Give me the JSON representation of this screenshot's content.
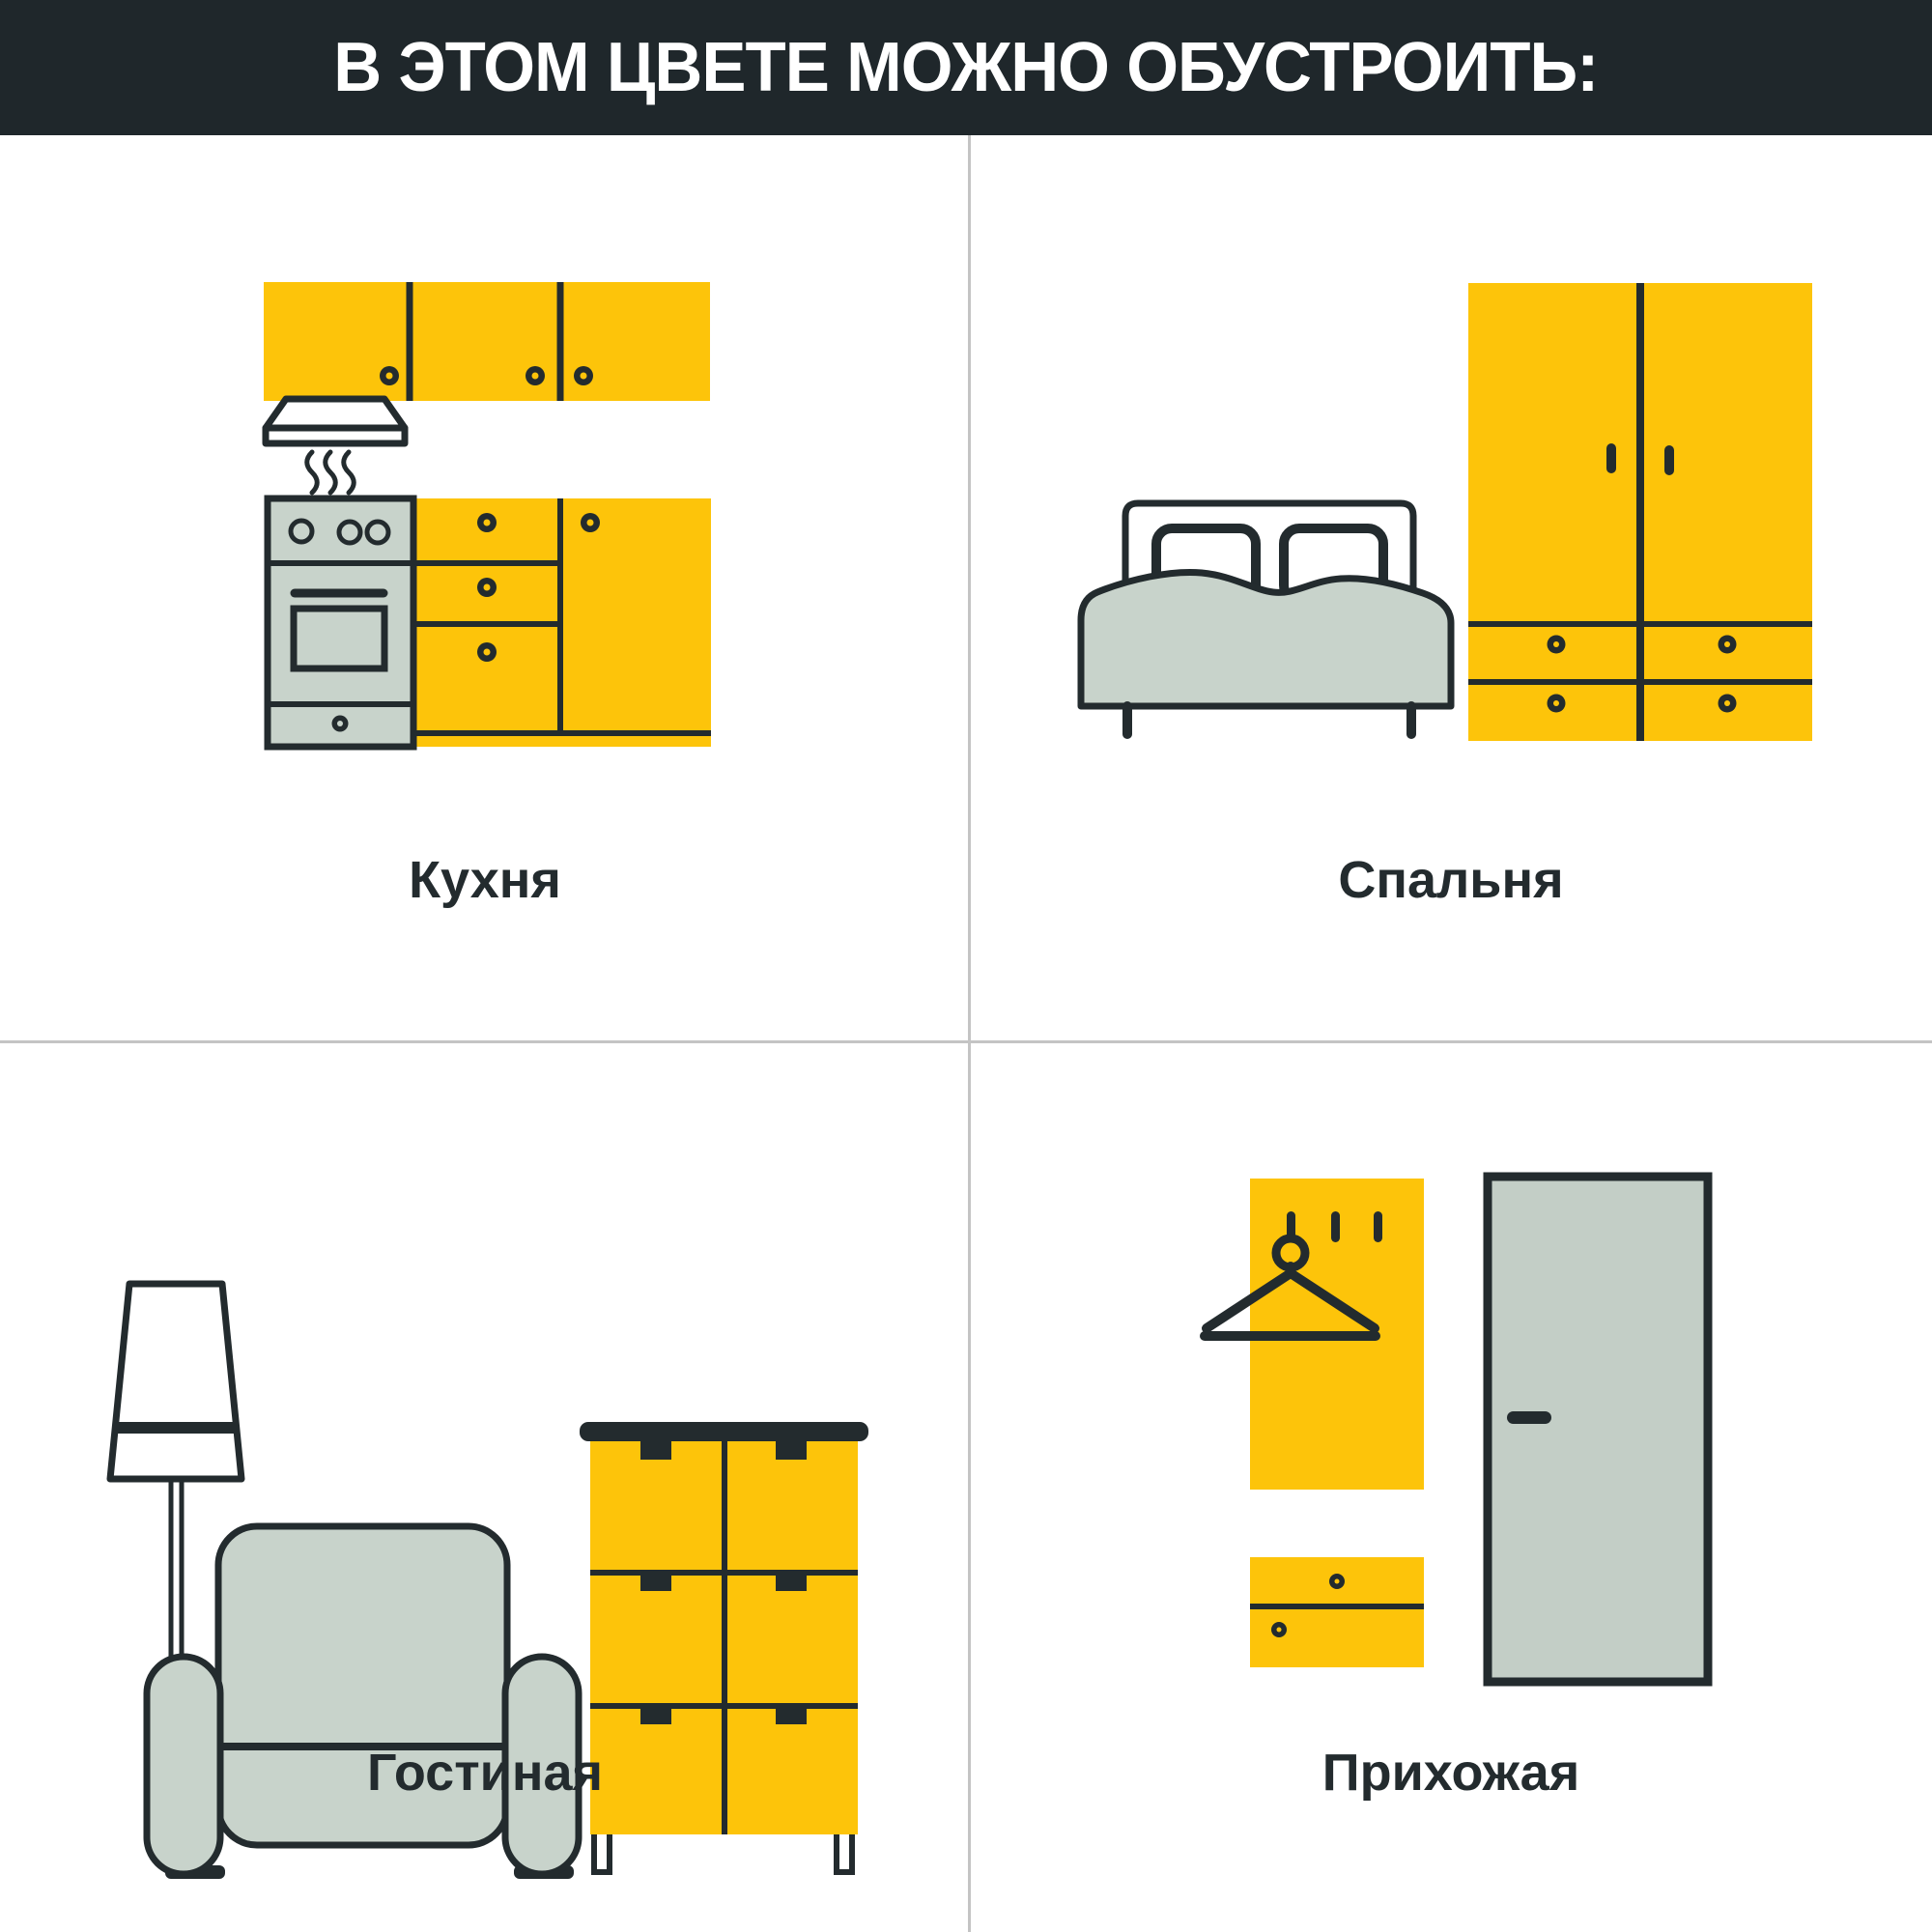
{
  "header": {
    "title": "В ЭТОМ ЦВЕТЕ МОЖНО ОБУСТРОИТЬ:"
  },
  "rooms": [
    {
      "id": "kitchen",
      "label": "Кухня",
      "illustration": "kitchen-furniture-icon"
    },
    {
      "id": "bedroom",
      "label": "Спальня",
      "illustration": "bedroom-furniture-icon"
    },
    {
      "id": "living-room",
      "label": "Гостиная",
      "illustration": "living-room-furniture-icon"
    },
    {
      "id": "hallway",
      "label": "Прихожая",
      "illustration": "hallway-furniture-icon"
    }
  ],
  "palette": {
    "accent-yellow": "#FDC40A",
    "ink-dark": "#232B2E",
    "header-bg": "#1F272B",
    "header-text": "#FFFFFF",
    "furniture-gray": "#C8D3CB",
    "door-gray": "#C3CEC6",
    "grid-line": "#C4C4C4",
    "background": "#FFFFFF"
  }
}
